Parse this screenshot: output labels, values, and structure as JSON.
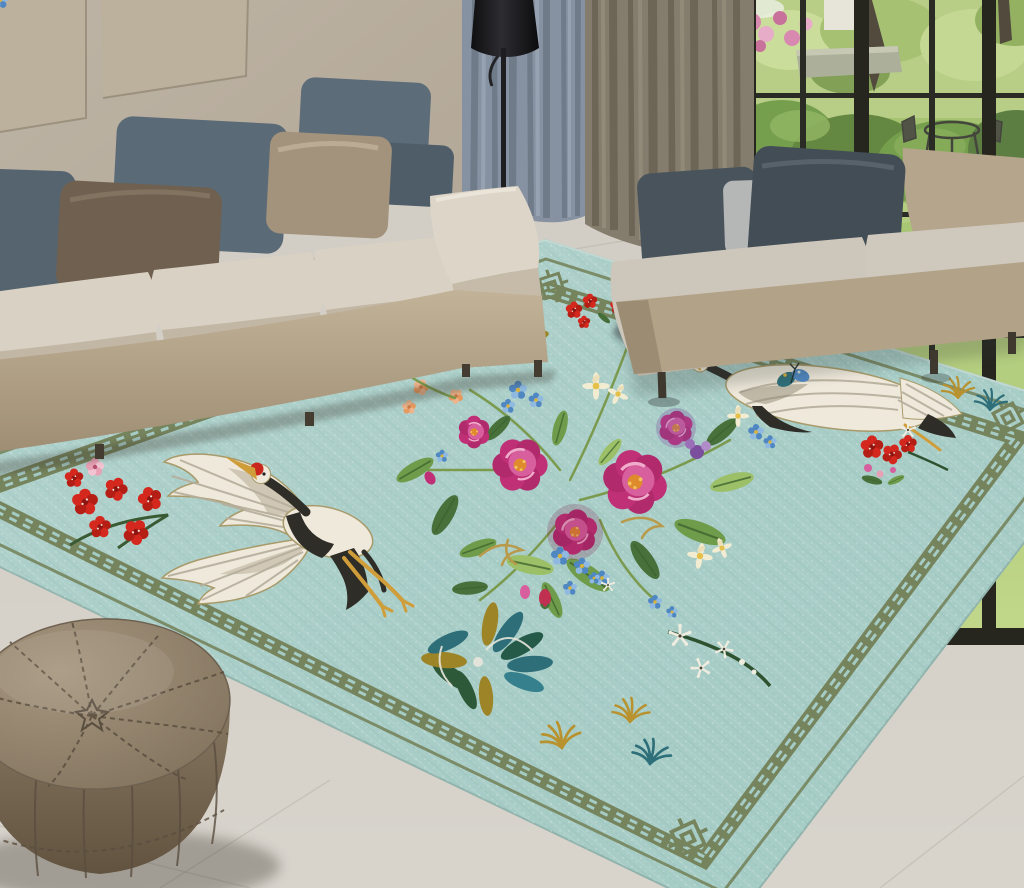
{
  "meta": {
    "description": "Product photograph of a teal chinoiserie embroidered area rug styled in a modern living room with beige sofas, garden window, curtains, black floor lamp and taupe leather pouf",
    "image_type": "interior product scene, no visible text"
  },
  "palette": {
    "wall": "#b3a897",
    "wall_panel": "#bcb19d",
    "wall_panel_edge": "#948a76",
    "curtain_blue": "#8691a1",
    "curtain_blue_dark": "#6d7887",
    "curtain_taupe": "#847c6d",
    "curtain_taupe_dark": "#696253",
    "lamp_black": "#1e1e21",
    "window_frame": "#26261f",
    "garden_lawn": "#abc973",
    "garden_canopy": "#b6cd82",
    "garden_bush": "#6f9a45",
    "garden_bush_dark": "#5d8238",
    "garden_pink": "#d684ac",
    "garden_trunk": "#4a4234",
    "floor": "#cdc8be",
    "floor_grout": "#b2ada1",
    "rug_field": "#a5cbc5",
    "rug_edge": "#8fb3ac",
    "rug_border": "#76845d",
    "crane_white": "#efe9db",
    "crane_black": "#2f2d28",
    "crane_red": "#c9261c",
    "crane_gold": "#cf9d3a",
    "flower_magenta": "#c03077",
    "flower_pink": "#d85f9e",
    "flower_highlight": "#efaccb",
    "flower_center_orange": "#e08a2e",
    "flower_blue": "#4f87c2",
    "flower_blue_light": "#8fb9e0",
    "flower_red": "#d4281e",
    "flower_peach": "#efb48c",
    "flower_cream": "#f2ecd2",
    "flower_white": "#efece0",
    "flower_purple": "#7c4f9e",
    "leaf_green": "#6f9c4b",
    "leaf_dark": "#47703a",
    "leaf_teal": "#2e6e79",
    "pine_gold": "#b8922e",
    "pine_teal": "#2e6f7a",
    "sofa_beige": "#bdae94",
    "sofa_beige_dark": "#a08f75",
    "sofa_cushion": "#d9d1c3",
    "sofa_cushion_front": "#c2b7a5",
    "sofa_right_base": "#b2a287",
    "sofa_right_end": "#9c8c73",
    "sofa_right_cushion": "#cdc6bb",
    "sofa_right_cushion_front": "#b9b1a4",
    "sofa_right_back": "#b5a58c",
    "pillow_slate": "#5c6c78",
    "pillow_slate2": "#5a6a76",
    "pillow_slate_cut": "#55646f",
    "pillow_slate_small": "#4f5d68",
    "pillow_dark1": "#49535b",
    "pillow_dark2": "#434d55",
    "pillow_brown": "#6f6050",
    "pillow_warmgray": "#a3927c",
    "pillow_lightgray": "#b4b7b6",
    "pouf_top": "#95856f",
    "pouf_side": "#8a7a66",
    "pouf_seam": "#5a4e3f",
    "shadow": "#3a342a"
  },
  "scene": {
    "wall": {
      "label": "beige wall",
      "panels": 2
    },
    "curtains": {
      "left_panel": "slate-blue linen curtain",
      "right_panel": "taupe linen curtain"
    },
    "window": {
      "label": "black-framed floor-to-ceiling window",
      "view": "garden: lawn, clipped shrubs, trees, pink flowering bush, stone planter, patio table and chairs, white house glimpse"
    },
    "floor_lamp": {
      "label": "black cone floor lamp"
    },
    "sofa_left": {
      "label": "beige modular sofa",
      "pillows": [
        "slate blue (cropped)",
        "brown",
        "slate blue",
        "warm gray",
        "slate blue",
        "slate blue lumbar"
      ]
    },
    "sofa_right": {
      "label": "beige backless daybed sofa on metal legs",
      "cushions": "light gray",
      "pillows": [
        "dark slate",
        "light gray",
        "dark slate"
      ]
    },
    "rug": {
      "label": "teal chinoiserie embroidered area rug",
      "border": "olive Greek-key meander band with corner knot motifs and thin guard line",
      "motifs": [
        "red-crowned crane in flight (left)",
        "second red-crowned crane partly under right sofa",
        "central bouquet of magenta peonies and wild roses",
        "forget-me-not blue clusters",
        "peach blossom spray",
        "cream and white daisies",
        "red plum-blossom cluster (left)",
        "red sprigs (top and right)",
        "white plum-blossom branch (bottom)",
        "teal pine-fan cloud motifs",
        "gold and teal pine-needle tufts",
        "blue butterfly",
        "gold scroll tendrils"
      ]
    },
    "pouf": {
      "label": "taupe Moroccan leather pouf with radial stitching"
    },
    "floor": {
      "label": "light warm-gray tile floor"
    }
  }
}
